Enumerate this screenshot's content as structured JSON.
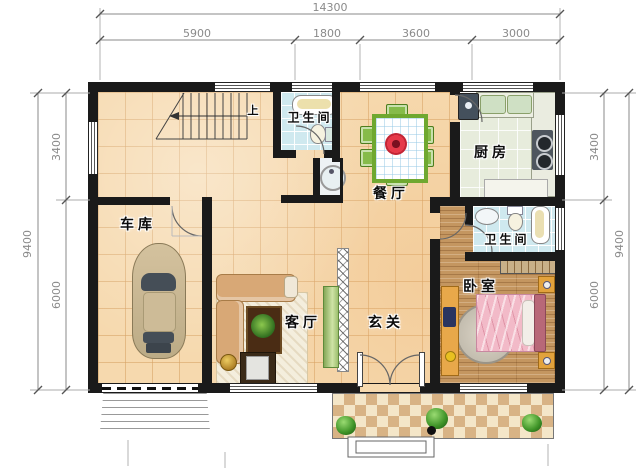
{
  "dimensions": {
    "top": {
      "total": "14300",
      "segments": [
        "5900",
        "1800",
        "3600",
        "3000"
      ]
    },
    "left": {
      "total": "9400",
      "segments": [
        "3400",
        "6000"
      ]
    },
    "right": {
      "total": "9400",
      "segments": [
        "3400",
        "6000"
      ]
    }
  },
  "rooms": {
    "garage": {
      "label": "车库"
    },
    "bathroom_top": {
      "label": "卫生间"
    },
    "dining": {
      "label": "餐厅"
    },
    "kitchen": {
      "label": "厨房"
    },
    "bathroom_right": {
      "label": "卫生间"
    },
    "bedroom": {
      "label": "卧室"
    },
    "living": {
      "label": "客厅"
    },
    "foyer": {
      "label": "玄关"
    }
  },
  "stairs": {
    "direction_label": "上"
  },
  "colors": {
    "wall": "#1a1a1a",
    "tile_floor": "#f6d9ae",
    "bath_floor": "#cfe9ef",
    "kitchen_floor": "#e7ecdc",
    "wood_floor": "#c49660",
    "porch_dark": "#d8b385",
    "porch_light": "#f4e6c8",
    "table_green": "#6fa830",
    "bed_pink": "#f2bac8"
  }
}
